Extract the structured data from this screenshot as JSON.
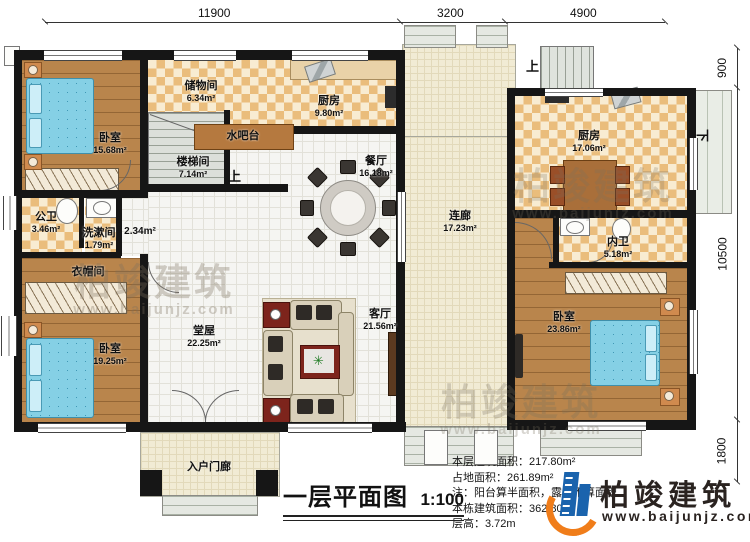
{
  "dimensions": {
    "top": [
      {
        "label": "11900"
      },
      {
        "label": "3200"
      },
      {
        "label": "4900"
      }
    ],
    "right": [
      {
        "label": "900"
      },
      {
        "label": "10500"
      },
      {
        "label": "1800"
      }
    ]
  },
  "rooms": {
    "bedroom_tl": {
      "label": "卧室",
      "area": "15.68m²"
    },
    "storage": {
      "label": "储物间",
      "area": "6.34m²"
    },
    "kitchen_left": {
      "label": "厨房",
      "area": "9.80m²"
    },
    "water_bar": {
      "label": "水吧台"
    },
    "stairwell": {
      "label": "楼梯间",
      "area": "7.14m²"
    },
    "public_bath": {
      "label": "公卫",
      "area": "3.46m²"
    },
    "washroom": {
      "label": "洗漱间",
      "area": "1.79m²"
    },
    "hall_nook": {
      "area": "2.34m²"
    },
    "cloakroom": {
      "label": "衣帽间"
    },
    "bedroom_bl": {
      "label": "卧室",
      "area": "19.25m²"
    },
    "main_hall": {
      "label": "堂屋",
      "area": "22.25m²"
    },
    "dining": {
      "label": "餐厅",
      "area": "16.18m²"
    },
    "living": {
      "label": "客厅",
      "area": "21.56m²"
    },
    "corridor": {
      "label": "连廊",
      "area": "17.23m²"
    },
    "kitchen_right": {
      "label": "厨房",
      "area": "17.06m²"
    },
    "inner_bath": {
      "label": "内卫",
      "area": "5.18m²"
    },
    "bedroom_r": {
      "label": "卧室",
      "area": "23.86m²"
    },
    "porch": {
      "label": "入户门廊"
    }
  },
  "stair_labels": {
    "up": "上",
    "down": "下"
  },
  "title": {
    "main": "一层平面图",
    "scale": "1:100"
  },
  "notes": {
    "l1": "本层建筑面积：217.80m²",
    "l2": "占地面积：261.89m²",
    "l3": "注：阳台算半面积，露台不算面积",
    "l4": "本栋建筑面积：362.80m²",
    "l5": "层高：3.72m"
  },
  "logo": {
    "name": "柏竣建筑",
    "website": "www.baijunjz.com"
  },
  "watermark": {
    "text": "柏竣建筑",
    "sub": "www.baijunjz.com"
  },
  "colors": {
    "wall": "#161616",
    "logo_blue": "#1a63ad",
    "logo_orange": "#f07d1a",
    "bed": "#85d0e5",
    "checker": "#eabd7c",
    "wood": "#b9854c"
  }
}
